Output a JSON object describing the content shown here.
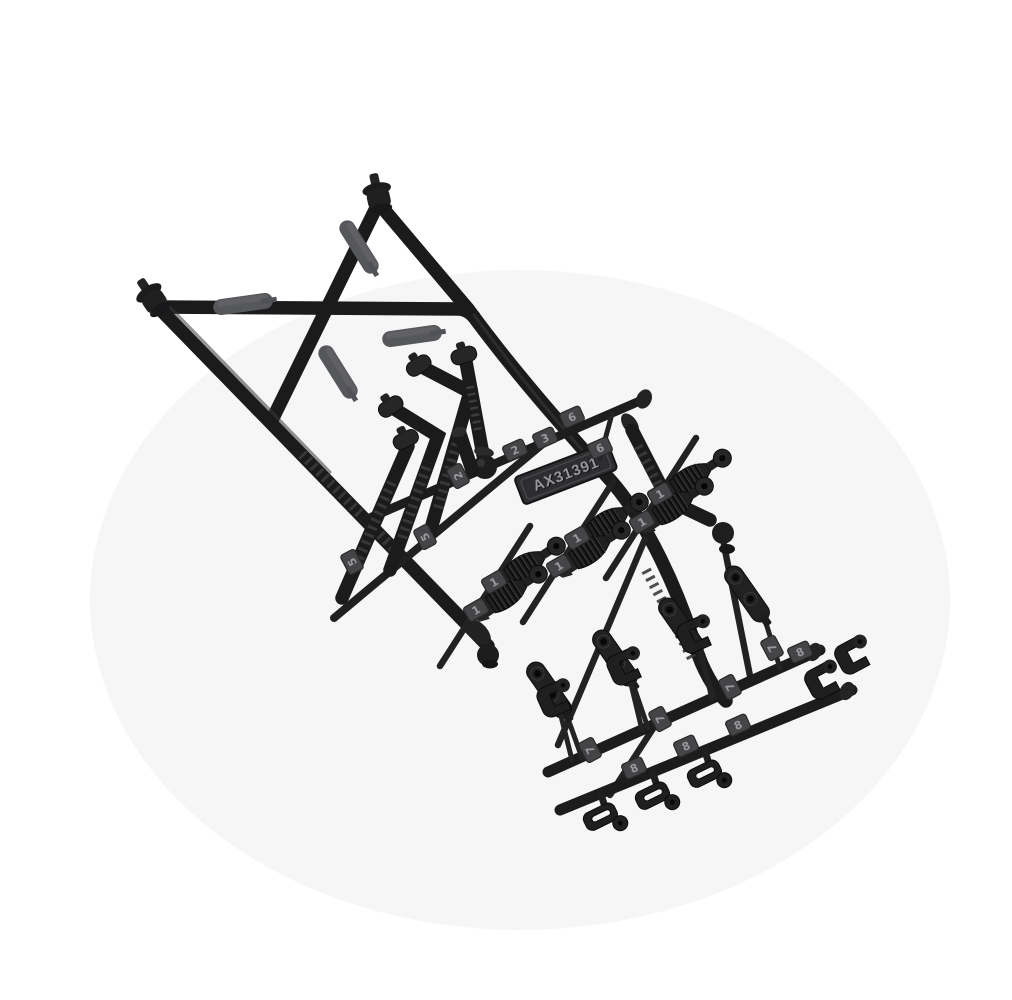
{
  "product": {
    "label": {
      "text": "AX31391"
    }
  },
  "tags": {
    "middle": [
      "2",
      "3",
      "6",
      "6",
      "2",
      "5",
      "5"
    ],
    "ones": [
      "1",
      "1",
      "1",
      "1",
      "1",
      "1"
    ],
    "sevens": [
      "7",
      "7",
      "7",
      "7"
    ],
    "eights": [
      "8",
      "8",
      "8",
      "8"
    ]
  },
  "palette": {
    "background": "#ffffff",
    "plastic_black": "#1b1b1c",
    "plastic_highlight": "#3a3a3c",
    "pad_gray": "#56575b",
    "tag_plate": "#454547",
    "emboss_text": "#9a9a9d",
    "label_plate": "#2e2e30",
    "soft_shadow": "rgba(0,0,0,0.05)"
  }
}
